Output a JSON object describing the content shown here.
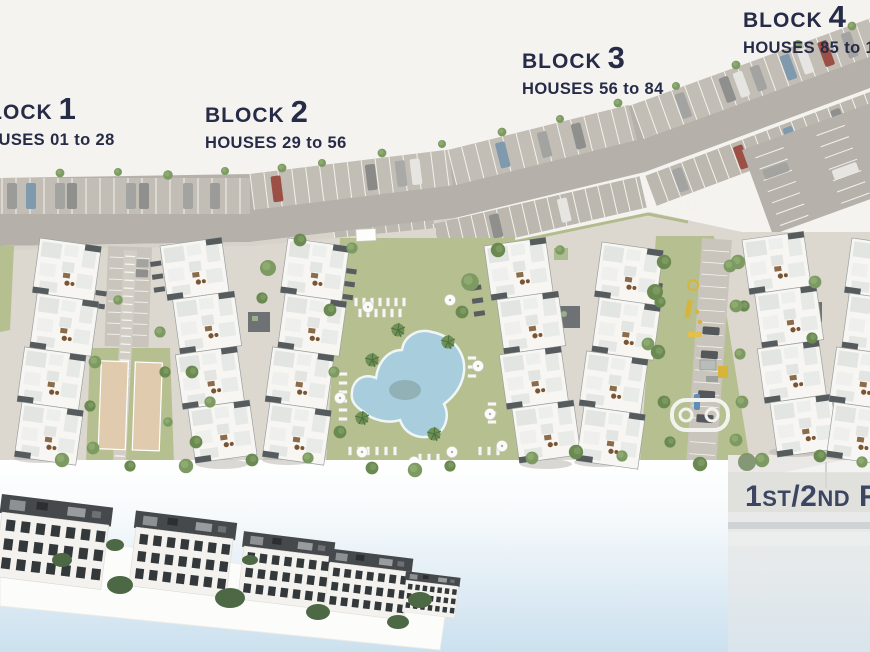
{
  "plan": {
    "blocks": [
      {
        "word": "BLOCK",
        "number": "1",
        "houses": "HOUSES 01 to 28"
      },
      {
        "word": "BLOCK",
        "number": "2",
        "houses": "HOUSES 29 to 56"
      },
      {
        "word": "BLOCK",
        "number": "3",
        "houses": "HOUSES 56 to 84"
      },
      {
        "word": "BLOCK",
        "number": "4",
        "houses": "HOUSES 85 to 1"
      }
    ],
    "floor_label": {
      "p1": "1",
      "p2": "ST",
      "p3": "/2",
      "p4": "ND",
      "p5": " F",
      "p6": "L"
    }
  },
  "colors": {
    "background": "#f5f3ef",
    "label_text": "#262c47",
    "floor_label_text": "#3c4663",
    "road": "#b5b1aa",
    "lawn": "#b6bf8f",
    "pool": "#a8cedd",
    "sports_court": "#e0cbae",
    "sky_gradient_bottom": "#cbe0ee"
  }
}
